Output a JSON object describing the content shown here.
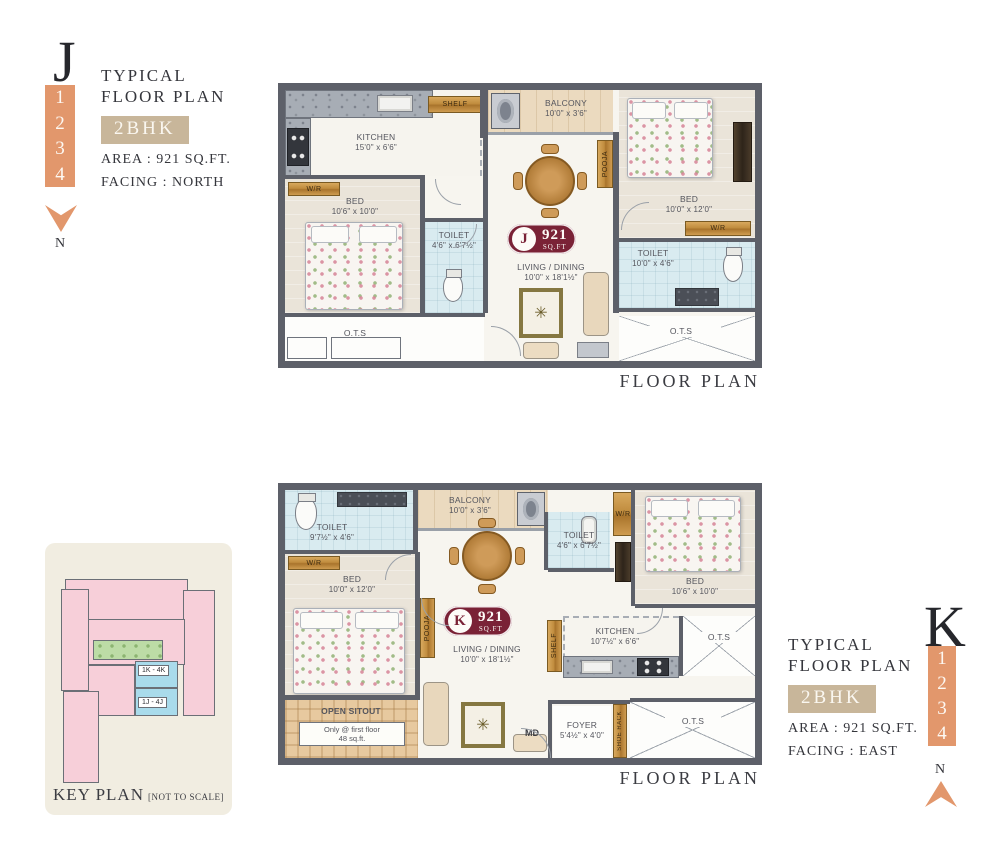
{
  "unit_j": {
    "letter": "J",
    "stack_numbers": [
      "1",
      "2",
      "3",
      "4"
    ],
    "title_line1": "TYPICAL",
    "title_line2": "FLOOR PLAN",
    "type_badge": "2BHK",
    "area_line": "AREA : 921 SQ.FT.",
    "facing_line": "FACING : NORTH",
    "compass_label": "N",
    "caption": "FLOOR PLAN",
    "badge": {
      "letter": "J",
      "value": "921",
      "unit": "SQ.FT"
    },
    "rooms": {
      "kitchen": {
        "name": "KITCHEN",
        "dims": "15'0\" x 6'6\""
      },
      "shelf": "SHELF",
      "balcony": {
        "name": "BALCONY",
        "dims": "10'0\" x 3'6\""
      },
      "bed_right": {
        "name": "BED",
        "dims": "10'0\" x 12'0\""
      },
      "bed_left": {
        "name": "BED",
        "dims": "10'6\" x 10'0\""
      },
      "toilet_center": {
        "name": "TOILET",
        "dims": "4'6\" x 6'7½\""
      },
      "toilet_right": {
        "name": "TOILET",
        "dims": "10'0\" x 4'6\""
      },
      "pooja": "POOJA",
      "wr": "W/R",
      "living": {
        "name": "LIVING / DINING",
        "dims": "10'0\" x 18'1½\""
      },
      "ots": "O.T.S"
    }
  },
  "unit_k": {
    "letter": "K",
    "stack_numbers": [
      "1",
      "2",
      "3",
      "4"
    ],
    "title_line1": "TYPICAL",
    "title_line2": "FLOOR PLAN",
    "type_badge": "2BHK",
    "area_line": "AREA : 921 SQ.FT.",
    "facing_line": "FACING : EAST",
    "compass_label": "N",
    "caption": "FLOOR PLAN",
    "badge": {
      "letter": "K",
      "value": "921",
      "unit": "SQ.FT"
    },
    "rooms": {
      "toilet_topleft": {
        "name": "TOILET",
        "dims": "9'7½\" x 4'6\""
      },
      "balcony": {
        "name": "BALCONY",
        "dims": "10'0\" x 3'6\""
      },
      "toilet_top": {
        "name": "TOILET",
        "dims": "4'6\" x 6'7½\""
      },
      "bed_right": {
        "name": "BED",
        "dims": "10'6\" x 10'0\""
      },
      "bed_left": {
        "name": "BED",
        "dims": "10'0\" x 12'0\""
      },
      "kitchen": {
        "name": "KITCHEN",
        "dims": "10'7½\" x 6'6\""
      },
      "shelf": "SHELF",
      "pooja": "POOJA",
      "wr": "W/R",
      "living": {
        "name": "LIVING / DINING",
        "dims": "10'0\" x 18'1½\""
      },
      "open_sitout": {
        "name": "OPEN SITOUT",
        "note_line1": "Only @ first floor",
        "note_line2": "48 sq.ft."
      },
      "foyer": {
        "name": "FOYER",
        "dims": "5'4½\" x 4'0\""
      },
      "md": "MD",
      "shoe_rack": "SHOE RACK",
      "ots": "O.T.S"
    }
  },
  "key_plan": {
    "title": "KEY PLAN",
    "subtitle": "[NOT TO SCALE]",
    "block_labels": [
      "1K - 4K",
      "1J - 4J"
    ]
  },
  "icons": {
    "rug_medallion": "✳"
  },
  "colors": {
    "accent_orange": "#E2976C",
    "badge_tan": "#C8B69A",
    "unit_badge_maroon": "#7A2236",
    "wall_gray": "#5D6069",
    "toilet_blue": "#D9EBF0",
    "bedroom_beige": "#EAE4D9",
    "balcony_tan": "#EBDABF",
    "wood_brown": "#C9924C",
    "keyplan_pink": "#F7CFD9",
    "keyplan_blue": "#A9DBEB",
    "keyplan_green": "#BCDCA6",
    "keyplan_cream": "#F1EDE1"
  }
}
